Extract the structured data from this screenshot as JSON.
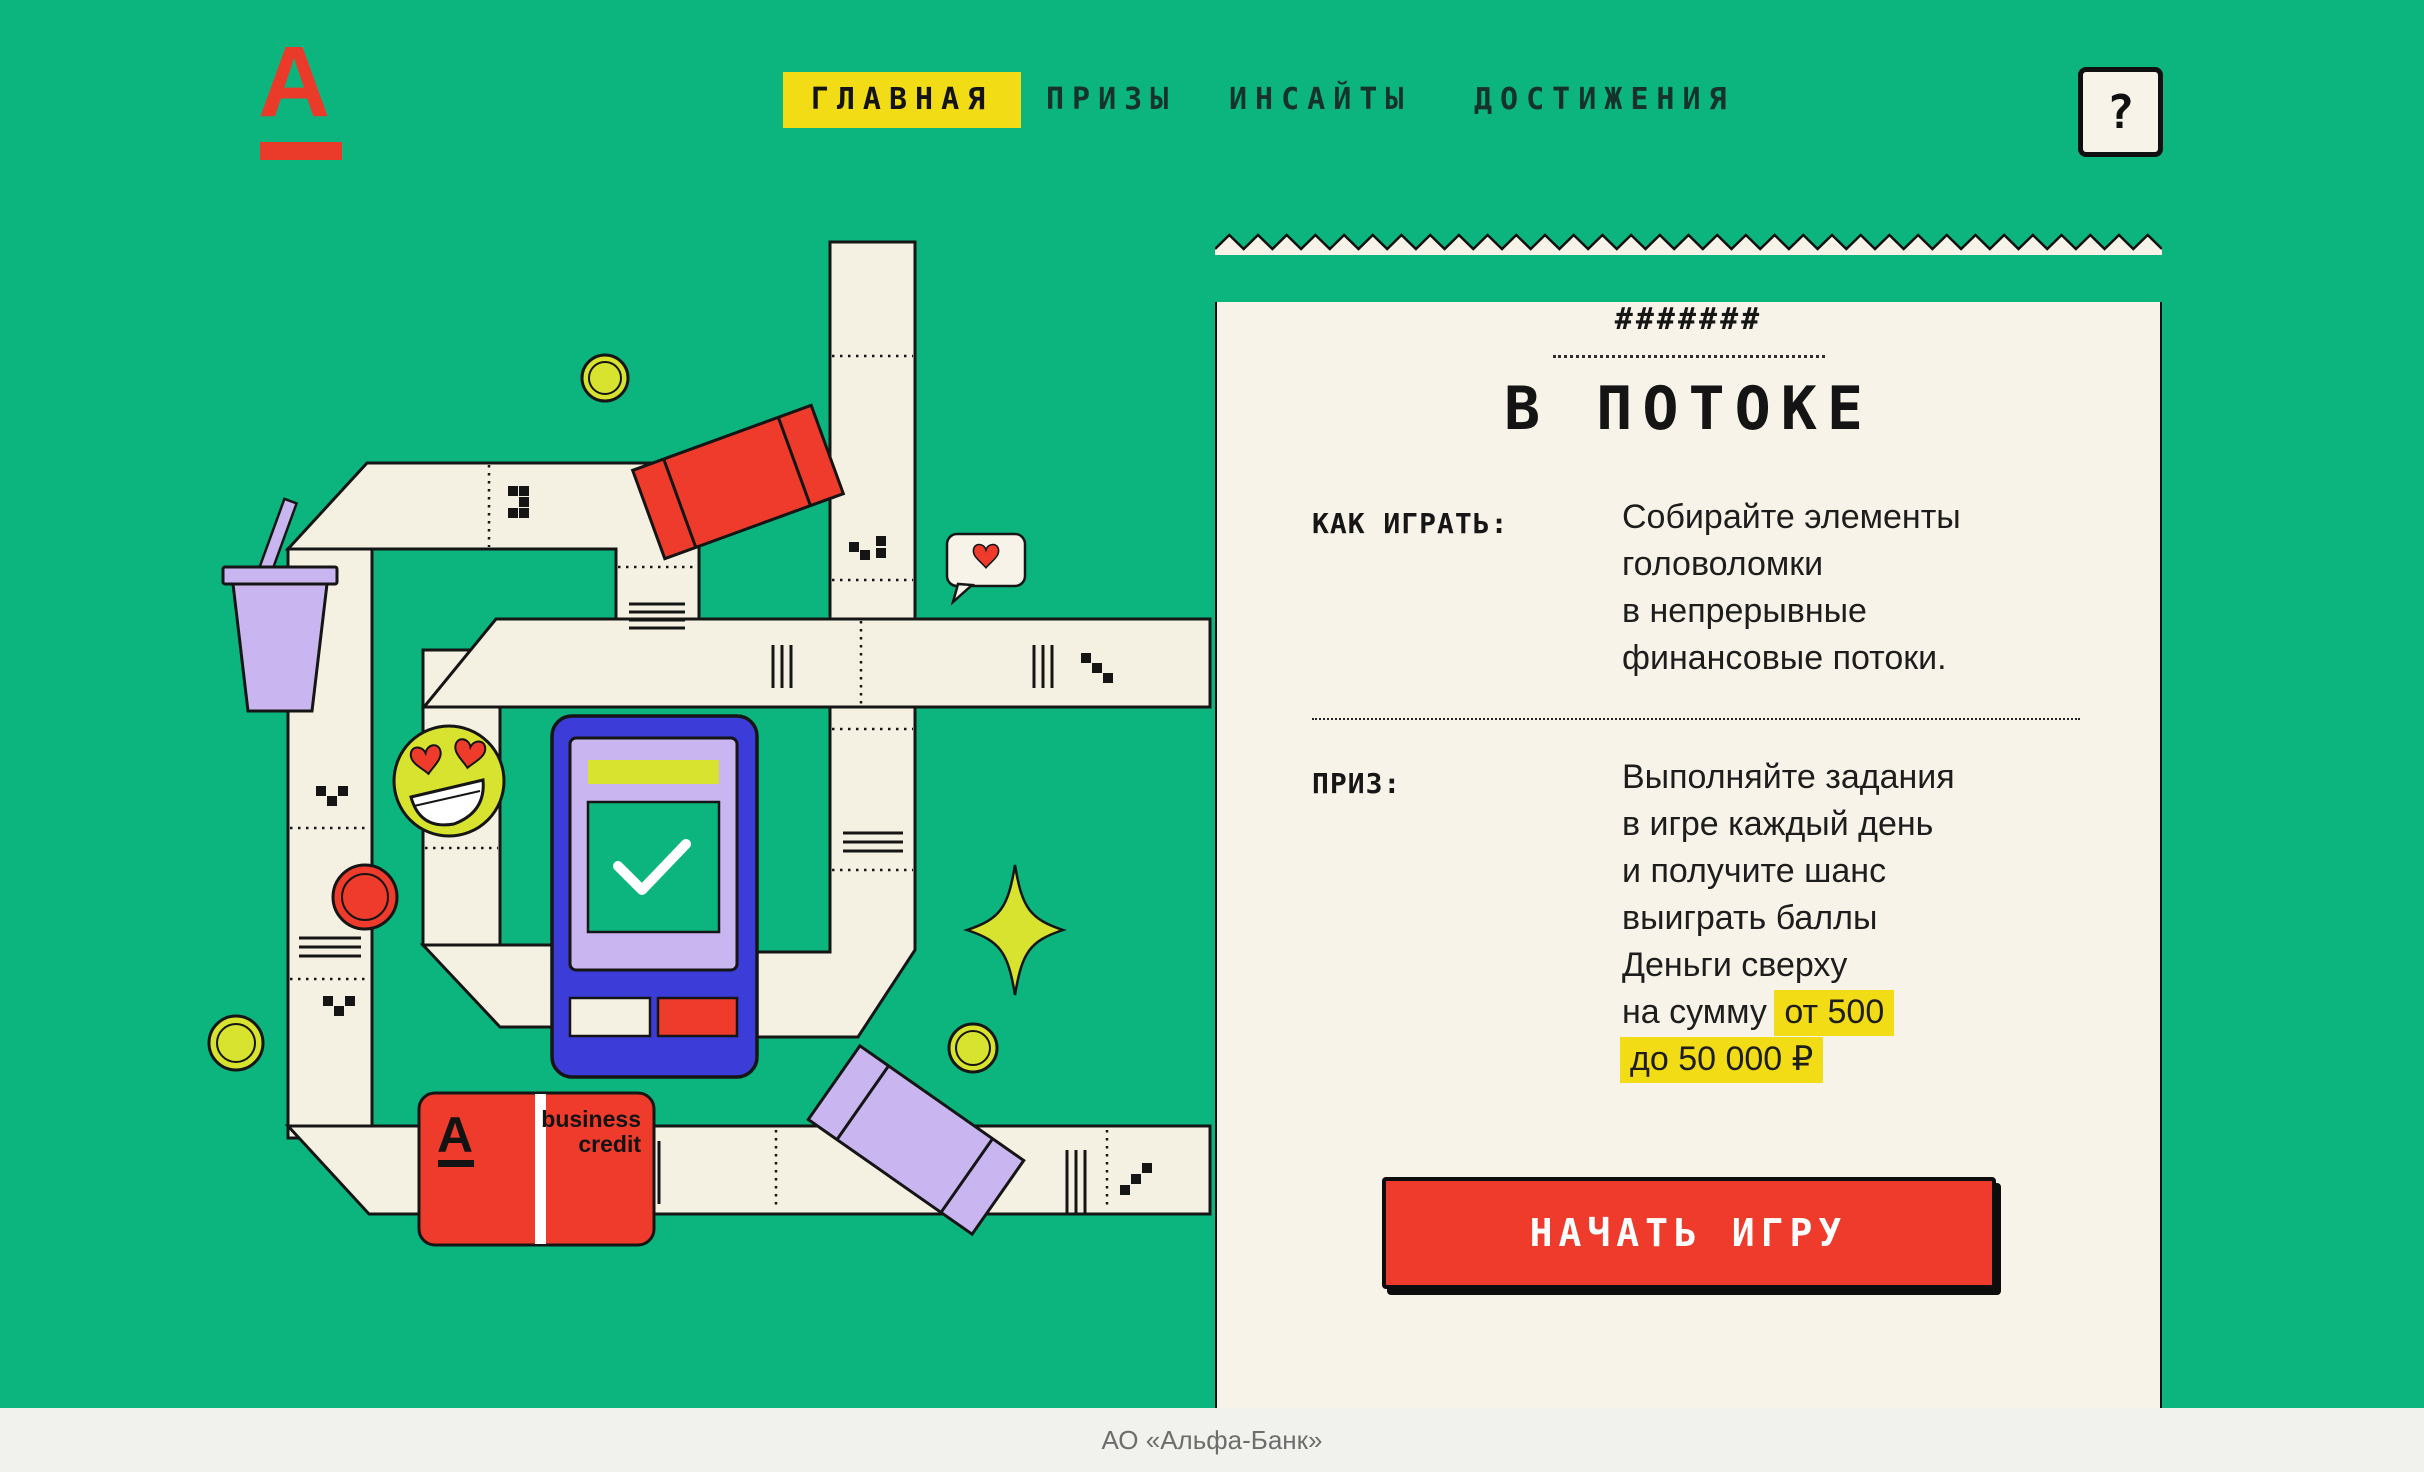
{
  "logo": {
    "letter": "А"
  },
  "nav": {
    "items": [
      {
        "label": "ГЛАВНАЯ",
        "active": true
      },
      {
        "label": "ПРИЗЫ",
        "active": false
      },
      {
        "label": "ИНСАЙТЫ",
        "active": false
      },
      {
        "label": "ДОСТИЖЕНИЯ",
        "active": false
      }
    ],
    "help_label": "?"
  },
  "receipt": {
    "masked_code": "#######",
    "title": "В ПОТОКЕ",
    "how_to": {
      "label": "КАК ИГРАТЬ:",
      "lines": [
        "Собирайте элементы",
        "головоломки",
        "в непрерывные",
        "финансовые потоки."
      ]
    },
    "prize": {
      "label": "ПРИЗ:",
      "lines": [
        [
          {
            "text": "Выполняйте задания",
            "hl": false
          }
        ],
        [
          {
            "text": "в игре каждый день",
            "hl": false
          }
        ],
        [
          {
            "text": "и получите шанс",
            "hl": false
          }
        ],
        [
          {
            "text": "выиграть баллы",
            "hl": false
          }
        ],
        [
          {
            "text": "Деньги сверху",
            "hl": false
          }
        ],
        [
          {
            "text": "на сумму ",
            "hl": false
          },
          {
            "text": "от 500",
            "hl": true
          }
        ],
        [
          {
            "text": "до 50 000 ₽",
            "hl": true
          }
        ]
      ]
    },
    "cta_label": "НАЧАТЬ ИГРУ"
  },
  "illustration": {
    "card": {
      "letter": "А",
      "line1": "business",
      "line2": "credit"
    }
  },
  "footer": {
    "text": "АО «Альфа-Банк»"
  },
  "colors": {
    "background": "#0cb57e",
    "cream": "#f5f1e2",
    "receipt": "#f7f3e8",
    "accent_yellow": "#f2dc15",
    "lime": "#d8e32f",
    "red": "#ee3b2c",
    "lilac": "#c9b6f0",
    "blue": "#3c3cd9",
    "ink": "#151515"
  }
}
